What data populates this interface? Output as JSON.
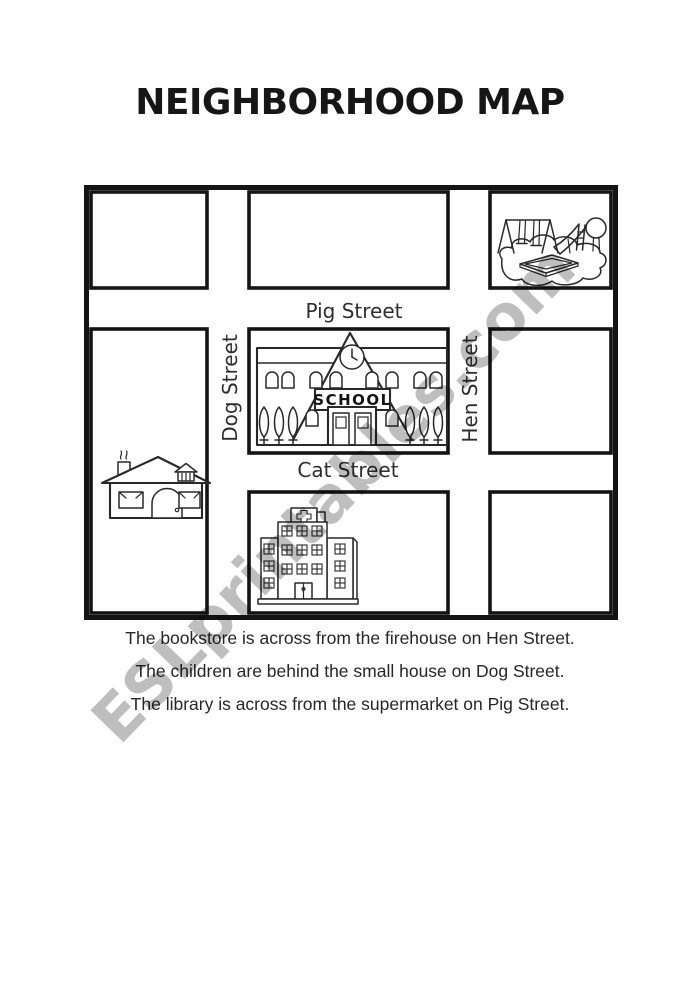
{
  "title": "NEIGHBORHOOD MAP",
  "watermark_text": "ESLprintables.com",
  "colors": {
    "ink": "#141414",
    "drawing_ink": "#282828",
    "watermark_gray": "#c3c3c3",
    "background": "#ffffff"
  },
  "map": {
    "street_labels": {
      "pig": "Pig Street",
      "cat": "Cat Street",
      "dog": "Dog Street",
      "hen": "Hen Street"
    },
    "school_sign": "SCHOOL",
    "icons": {
      "top_right_block": "playground-icon",
      "center_block": "school-icon",
      "left_block": "house-icon",
      "bottom_center_block": "hospital-icon"
    }
  },
  "sentences": [
    "The bookstore is across from the firehouse on Hen Street.",
    "The children are behind the small house on Dog Street.",
    "The library is across from the supermarket on Pig Street."
  ]
}
